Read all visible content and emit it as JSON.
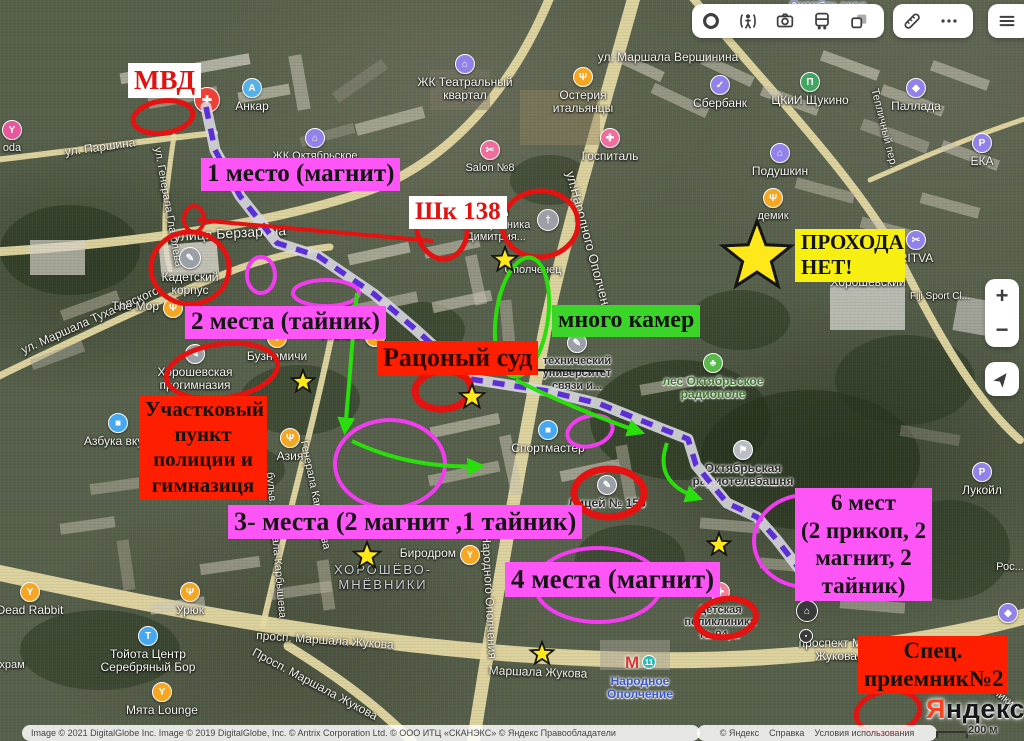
{
  "toolbar": {
    "groups": [
      [
        "traffic",
        "panoramas",
        "photos",
        "transport",
        "layers"
      ],
      [
        "ruler",
        "more"
      ],
      [
        "menu"
      ]
    ]
  },
  "map_controls": {
    "zoom_in": "+",
    "zoom_out": "−"
  },
  "logo": {
    "ya": "Я",
    "rest": "ндекс"
  },
  "scale_label": "200 м",
  "attribution": {
    "left": "Image © 2021 DigitalGlobe Inc. Image © 2019 DigitalGlobe, Inc. © Antrix Corporation Ltd. © ООО ИТЦ «СКАНЭКС» © Яндекс Правообладатели",
    "links": [
      "© Яндекс",
      "Справка",
      "Условия использования"
    ]
  },
  "metro": {
    "symbol": "М",
    "line": "11",
    "name_line1": "Народное",
    "name_line2": "Ополчение"
  },
  "annotations": {
    "banners": [
      {
        "id": "mvd",
        "t": "МВД",
        "x": 128,
        "y": 63,
        "fs": 27,
        "bg": "#ffffff",
        "fg": "#e01310"
      },
      {
        "id": "place1",
        "t": "1 место (магнит)",
        "x": 201,
        "y": 158,
        "fs": 25,
        "bg": "#fe55f7",
        "fg": "#141414"
      },
      {
        "id": "shk138",
        "t": "Шк 138",
        "x": 409,
        "y": 196,
        "fs": 25,
        "bg": "#ffffff",
        "fg": "#e01310"
      },
      {
        "id": "place2",
        "t": "2 места (тайник)",
        "x": 185,
        "y": 306,
        "fs": 25,
        "bg": "#fe55f7",
        "fg": "#141414"
      },
      {
        "id": "court",
        "t": "Рацоный суд",
        "x": 377,
        "y": 341,
        "fs": 26,
        "bg": "#fe1e00",
        "fg": "#330000"
      },
      {
        "id": "cameras",
        "t": "много камер",
        "x": 552,
        "y": 305,
        "fs": 24,
        "bg": "#3bd529",
        "fg": "#141414"
      },
      {
        "id": "nopass",
        "t": "ПРОХОДА\nНЕТ!",
        "x": 795,
        "y": 229,
        "fs": 21,
        "bg": "#f7ee12",
        "fg": "#141414",
        "w": 110,
        "ta": "left"
      },
      {
        "id": "police",
        "t": "Участковый\nпункт\nполиции и\nгимназиця",
        "x": 139,
        "y": 396,
        "fs": 21,
        "bg": "#fe1e00",
        "fg": "#141414",
        "w": 128
      },
      {
        "id": "place3",
        "t": "3- места (2 магнит ,1 тайник)",
        "x": 228,
        "y": 505,
        "fs": 26,
        "bg": "#fe55f7",
        "fg": "#141414"
      },
      {
        "id": "place4",
        "t": "4 места (магнит)",
        "x": 505,
        "y": 562,
        "fs": 27,
        "bg": "#fe55f7",
        "fg": "#141414"
      },
      {
        "id": "place6",
        "t": "6 мест\n(2 прикоп, 2\nмагнит, 2\nтайник)",
        "x": 795,
        "y": 488,
        "fs": 23,
        "bg": "#fe55f7",
        "fg": "#141414",
        "w": 137
      },
      {
        "id": "special",
        "t": "Спец.\nприемник№2",
        "x": 858,
        "y": 636,
        "fs": 23,
        "bg": "#fe1e00",
        "fg": "#141414",
        "w": 150
      }
    ],
    "ellipses": {
      "red": [
        [
          163,
          117,
          30,
          16,
          -8,
          5
        ],
        [
          194,
          219,
          10,
          13,
          0,
          4
        ],
        [
          190,
          268,
          39,
          36,
          0,
          5
        ],
        [
          442,
          228,
          25,
          31,
          -8,
          5
        ],
        [
          540,
          224,
          38,
          33,
          -5,
          5
        ],
        [
          222,
          371,
          56,
          27,
          -8,
          5
        ],
        [
          443,
          390,
          28,
          19,
          -5,
          7
        ],
        [
          609,
          493,
          35,
          24,
          0,
          7
        ],
        [
          726,
          618,
          30,
          19,
          -8,
          6
        ],
        [
          888,
          712,
          32,
          21,
          -10,
          5
        ]
      ],
      "magenta": [
        [
          261,
          275,
          14,
          18,
          0,
          4
        ],
        [
          326,
          293,
          33,
          13,
          0,
          4
        ],
        [
          390,
          464,
          55,
          44,
          0,
          4
        ],
        [
          590,
          431,
          23,
          15,
          -15,
          4
        ],
        [
          598,
          585,
          63,
          37,
          0,
          4
        ],
        [
          806,
          541,
          52,
          46,
          0,
          4
        ]
      ],
      "green": [
        [
          522,
          317,
          26,
          60,
          8,
          4
        ]
      ]
    },
    "arrows": [
      "M357,293 C352,340 349,390 345,430",
      "M352,441 C395,462 442,468 480,466",
      "M516,380 C555,400 605,420 640,432",
      "M667,443 C658,468 666,487 698,498"
    ],
    "route": "M206,107 L215,150 240,196 277,243 318,256 374,294 414,328 470,379 547,391 600,404 650,424 688,439 696,465 727,503 757,517 777,540 800,570",
    "red_line": "M198,220 L433,241",
    "black_line": "M465,369 L604,371",
    "stars": [
      [
        505,
        260,
        13
      ],
      [
        757,
        257,
        36
      ],
      [
        472,
        397,
        13
      ],
      [
        303,
        382,
        12
      ],
      [
        367,
        556,
        14
      ],
      [
        719,
        545,
        12
      ],
      [
        542,
        654,
        12
      ]
    ]
  },
  "pois": [
    {
      "t": "oda",
      "x": 12,
      "y": 130,
      "c": "#e8579a",
      "g": "Y"
    },
    {
      "t": "Анкар",
      "x": 252,
      "y": 88,
      "c": "#55b1e8",
      "g": "A",
      "ls": 12
    },
    {
      "t": "",
      "x": 207,
      "y": 100,
      "c": "#ee4035",
      "g": "✚",
      "r": 13
    },
    {
      "t": "ЖК Октябрьское",
      "x": 315,
      "y": 138,
      "c": "#9181e8",
      "g": "⌂"
    },
    {
      "t": "ЖК Театральный\nквартал",
      "x": 465,
      "y": 64,
      "c": "#9181e8",
      "g": "⌂",
      "ls": 12
    },
    {
      "t": "Остерия\nитальянцы",
      "x": 583,
      "y": 77,
      "c": "#f5a623",
      "g": "Ψ",
      "ls": 12
    },
    {
      "t": "Госпиталь",
      "x": 610,
      "y": 138,
      "c": "#f06e9c",
      "g": "✚",
      "ls": 12
    },
    {
      "t": "Salon №8",
      "x": 490,
      "y": 150,
      "c": "#f06e9c",
      "g": "✂"
    },
    {
      "t": "Сбербанк",
      "x": 720,
      "y": 85,
      "c": "#9181e8",
      "g": "✓",
      "ls": 12
    },
    {
      "t": "ЦКиИ Щукино",
      "x": 810,
      "y": 82,
      "c": "#43a564",
      "g": "П",
      "ls": 12
    },
    {
      "t": "Паллада",
      "x": 916,
      "y": 88,
      "c": "#9181e8",
      "g": "◆",
      "ls": 12
    },
    {
      "t": "Подушкин",
      "x": 780,
      "y": 153,
      "c": "#9181e8",
      "g": "⌂",
      "ls": 12
    },
    {
      "t": "ЕКА",
      "x": 982,
      "y": 143,
      "c": "#9181e8",
      "g": "P",
      "ls": 12
    },
    {
      "t": "демик",
      "x": 773,
      "y": 198,
      "c": "#f5a623",
      "g": "Ψ"
    },
    {
      "t": "RITVA",
      "x": 916,
      "y": 240,
      "c": "#9181e8",
      "g": "✂",
      "ls": 12
    },
    {
      "t": "Fiji Sport Cl...",
      "x": 940,
      "y": 297,
      "ls": 10
    },
    {
      "t": "Хорошевский",
      "x": 868,
      "y": 283,
      "ls": 12
    },
    {
      "t": "",
      "x": 548,
      "y": 220,
      "c": "#9aa0a6",
      "g": "†",
      "r": 11
    },
    {
      "t": "храм\n...комученика\nДимитрия...",
      "x": 496,
      "y": 225,
      "ls": 11
    },
    {
      "t": "Ополченец",
      "x": 533,
      "y": 270,
      "ls": 11
    },
    {
      "t": "Кадетский\nкорпус",
      "x": 190,
      "y": 258,
      "c": "#9aa0a6",
      "g": "✎",
      "ls": 12,
      "r": 11
    },
    {
      "t": "The Мор",
      "x": 173,
      "y": 308,
      "c": "#f5a623",
      "g": "Ψ",
      "lp": "l",
      "ls": 12
    },
    {
      "t": "Бузнамичи",
      "x": 277,
      "y": 338,
      "c": "#f5a623",
      "g": "Ψ",
      "ls": 12
    },
    {
      "t": "Алло...",
      "x": 375,
      "y": 337,
      "c": "#f5a623",
      "g": "Ψ",
      "lp": "l",
      "ls": 12
    },
    {
      "t": "Азия",
      "x": 290,
      "y": 438,
      "c": "#f5a623",
      "g": "Ψ",
      "ls": 12
    },
    {
      "t": "Хорошевская\nпрогимназия",
      "x": 195,
      "y": 354,
      "c": "#9aa0a6",
      "g": "✎",
      "ls": 12
    },
    {
      "t": "Азбука вку...",
      "x": 118,
      "y": 423,
      "c": "#46a8f0",
      "g": "■",
      "ls": 12
    },
    {
      "t": "Спортмастер",
      "x": 548,
      "y": 430,
      "c": "#46a8f0",
      "g": "■",
      "ls": 12
    },
    {
      "t": "технический\nуниверситет\nсвязи и...",
      "x": 577,
      "y": 343,
      "c": "#9aa0a6",
      "g": "✎",
      "lc": "#2e2e2e",
      "h": "l",
      "ls": 11
    },
    {
      "t": "лес Октябрьское\nрадиополе",
      "x": 713,
      "y": 363,
      "c": "#58b849",
      "g": "♣",
      "lc": "#3e7a2e",
      "h": "l",
      "ls": 12
    },
    {
      "t": "Октябрьская\nрадиотелебашня",
      "x": 743,
      "y": 450,
      "c": "#b9bdc4",
      "g": "⚑",
      "lc": "#2e2e2e",
      "h": "l",
      "ls": 12
    },
    {
      "t": "Лицей № 156",
      "x": 607,
      "y": 485,
      "c": "#9aa0a6",
      "g": "✎",
      "lc": "#2e2e2e",
      "h": "l",
      "ls": 12
    },
    {
      "t": "Биродром",
      "x": 470,
      "y": 555,
      "c": "#f5a623",
      "g": "Y",
      "lp": "l",
      "ls": 12
    },
    {
      "t": "ХОРОШЁВО-\nМНЁВНИКИ",
      "x": 383,
      "y": 578,
      "lc": "#c9ced6",
      "ls": 13,
      "sp": 1
    },
    {
      "t": "Детская\nполиклиника\n№ 94,...",
      "x": 720,
      "y": 592,
      "c": "#f08098",
      "g": "✚",
      "lc": "#2e2e2e",
      "h": "l",
      "ls": 11
    },
    {
      "t": "проспект Маршала\nЖукова, 16к3",
      "x": 852,
      "y": 650,
      "ls": 12
    },
    {
      "t": "Лукойл",
      "x": 982,
      "y": 472,
      "c": "#9181e8",
      "g": "P",
      "ls": 12
    },
    {
      "t": "Рос...",
      "x": 1010,
      "y": 567,
      "ls": 11
    },
    {
      "t": "Тойота Центр\nСеребряный Бор",
      "x": 148,
      "y": 636,
      "c": "#46a8f0",
      "g": "T",
      "ls": 12
    },
    {
      "t": "Мята Lounge",
      "x": 162,
      "y": 692,
      "c": "#f5a623",
      "g": "Y",
      "ls": 12
    },
    {
      "t": "Dead Rabbit",
      "x": 30,
      "y": 592,
      "c": "#f5a623",
      "g": "Y",
      "ls": 12
    },
    {
      "t": "Урюк",
      "x": 190,
      "y": 592,
      "c": "#f5a623",
      "g": "Ψ",
      "ls": 12
    },
    {
      "t": "храм",
      "x": 12,
      "y": 665,
      "ls": 11
    },
    {
      "t": "",
      "x": 807,
      "y": 611,
      "c": "#3a3a3a",
      "g": "⌂",
      "r": 11
    },
    {
      "t": "",
      "x": 806,
      "y": 636,
      "c": "#3a3a3a",
      "g": "▪",
      "r": 7
    },
    {
      "t": "",
      "x": 1008,
      "y": 613,
      "c": "#9181e8",
      "g": "◆",
      "r": 10
    },
    {
      "t": "Октябрьское",
      "x": 828,
      "y": 6,
      "lc": "#7388dd",
      "h": "l",
      "ls": 12
    },
    {
      "metro": true,
      "x": 632,
      "y": 663
    }
  ],
  "streets": [
    {
      "t": "улица Берзарина",
      "x": 230,
      "y": 233,
      "r": -3,
      "s": 14
    },
    {
      "t": "ул. Паршина",
      "x": 100,
      "y": 147,
      "r": -8,
      "s": 12
    },
    {
      "t": "ул. Маршала Тухачевского",
      "x": 90,
      "y": 320,
      "r": -24,
      "s": 12
    },
    {
      "t": "ул. Генерала Глаголева",
      "x": 168,
      "y": 207,
      "r": 80,
      "s": 11
    },
    {
      "t": "ул.Народного Ополчения",
      "x": 590,
      "y": 245,
      "r": 75,
      "s": 13
    },
    {
      "t": "Ул.Народного Ополчения",
      "x": 489,
      "y": 588,
      "r": 87,
      "s": 12
    },
    {
      "t": "Тепличный пер.",
      "x": 884,
      "y": 128,
      "r": 76,
      "s": 11
    },
    {
      "t": "ул. Маршала Вершинина",
      "x": 668,
      "y": 57,
      "r": 0,
      "s": 12
    },
    {
      "t": "просп. Маршала Жукова",
      "x": 325,
      "y": 640,
      "r": 4,
      "s": 12
    },
    {
      "t": "Просп. Маршала Жукова",
      "x": 315,
      "y": 684,
      "r": 28,
      "s": 12
    },
    {
      "t": "Маршала Жукова",
      "x": 538,
      "y": 672,
      "r": 2,
      "s": 12
    },
    {
      "t": "бульв. Генерала Карбышева",
      "x": 276,
      "y": 545,
      "r": 85,
      "s": 11
    },
    {
      "t": "Генерала Карбышева",
      "x": 315,
      "y": 495,
      "r": 78,
      "s": 11
    },
    {
      "t": "ул. Мнёвники",
      "x": 986,
      "y": 684,
      "r": 38,
      "s": 11
    }
  ]
}
